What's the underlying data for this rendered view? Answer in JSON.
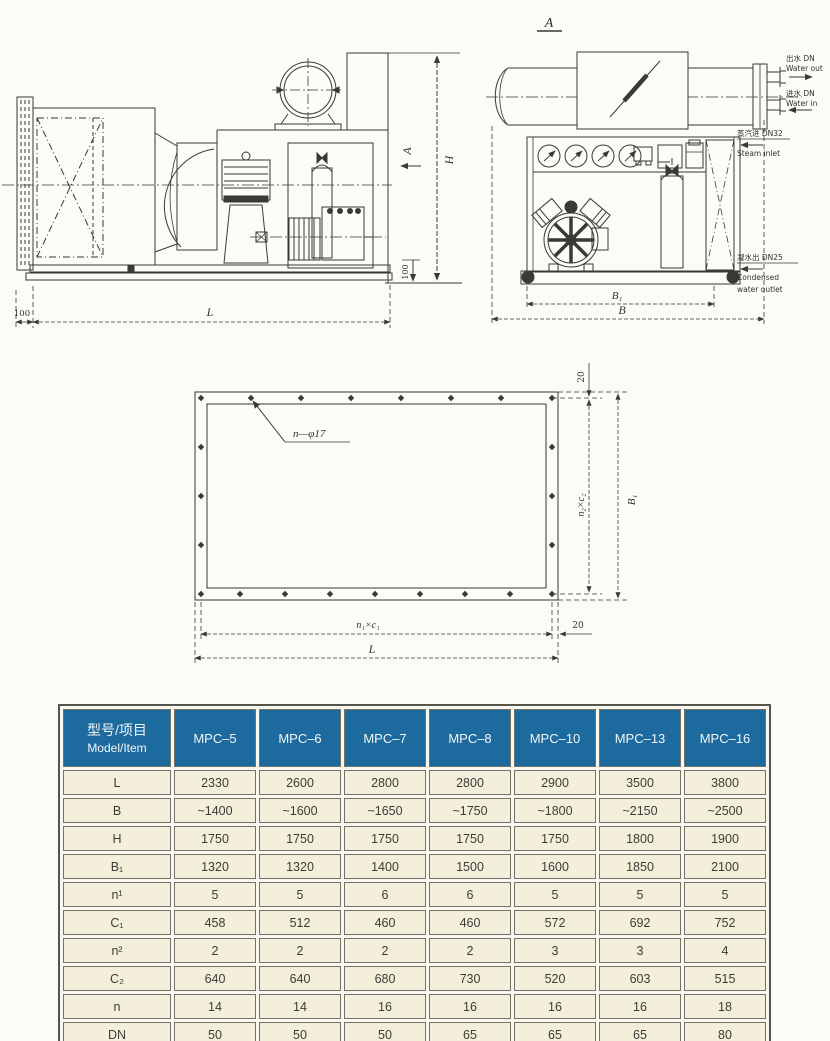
{
  "side_view": {
    "section_label": "A",
    "dim_H": "H",
    "dim_L": "L",
    "dim_base_height": "100",
    "dim_left_offset": "100"
  },
  "front_view": {
    "view_label": "A",
    "dim_B1": "B₁",
    "dim_B": "B",
    "ports": {
      "water_out_cn": "出水 DN",
      "water_out_en": "Water out",
      "water_in_cn": "进水 DN",
      "water_in_en": "Water in",
      "steam_in_cn": "蒸汽进 DN32",
      "steam_in_en": "Steam inlet",
      "cond_out_cn": "凝水出 DN25",
      "cond_out_en1": "Condensed",
      "cond_out_en2": "water outlet"
    }
  },
  "flange_view": {
    "holes_label": "n—φ17",
    "dim_top_offset": "20",
    "dim_right_pitch": "n₂×c₂",
    "dim_right_overall": "B₁",
    "dim_bottom_pitch": "n₁×c₁",
    "dim_bottom_overall": "L",
    "dim_corner_offset": "20"
  },
  "table": {
    "header": {
      "model_cn": "型号/项目",
      "model_en": "Model/Item"
    },
    "models": [
      "MPC–5",
      "MPC–6",
      "MPC–7",
      "MPC–8",
      "MPC–10",
      "MPC–13",
      "MPC–16"
    ],
    "rows": [
      {
        "label": "L",
        "values": [
          "2330",
          "2600",
          "2800",
          "2800",
          "2900",
          "3500",
          "3800"
        ]
      },
      {
        "label": "B",
        "values": [
          "~1400",
          "~1600",
          "~1650",
          "~1750",
          "~1800",
          "~2150",
          "~2500"
        ]
      },
      {
        "label": "H",
        "values": [
          "1750",
          "1750",
          "1750",
          "1750",
          "1750",
          "1800",
          "1900"
        ]
      },
      {
        "label": "B₁",
        "values": [
          "1320",
          "1320",
          "1400",
          "1500",
          "1600",
          "1850",
          "2100"
        ]
      },
      {
        "label": "n¹",
        "values": [
          "5",
          "5",
          "6",
          "6",
          "5",
          "5",
          "5"
        ]
      },
      {
        "label": "C₁",
        "values": [
          "458",
          "512",
          "460",
          "460",
          "572",
          "692",
          "752"
        ]
      },
      {
        "label": "n²",
        "values": [
          "2",
          "2",
          "2",
          "2",
          "3",
          "3",
          "4"
        ]
      },
      {
        "label": "C₂",
        "values": [
          "640",
          "640",
          "680",
          "730",
          "520",
          "603",
          "515"
        ]
      },
      {
        "label": "n",
        "values": [
          "14",
          "14",
          "16",
          "16",
          "16",
          "16",
          "18"
        ]
      },
      {
        "label": "DN",
        "values": [
          "50",
          "50",
          "50",
          "65",
          "65",
          "65",
          "80"
        ]
      }
    ],
    "colors": {
      "header_bg": "#1d6a9e",
      "header_text": "#f2f6f9",
      "cell_bg": "#f4efdb",
      "cell_border": "#72726a",
      "value_text": "#3c3c36"
    }
  }
}
